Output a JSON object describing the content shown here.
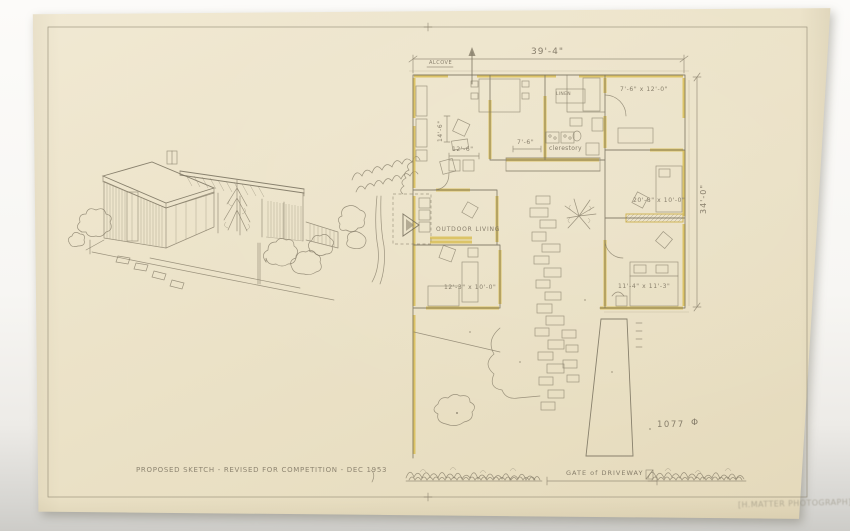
{
  "inscriptions": {
    "title": "PROPOSED SKETCH - REVISED FOR COMPETITION - DEC 1953",
    "gate": "GATE of DRIVEWAY",
    "lot_number": "1077",
    "lot_symbol": "Φ",
    "stamp": "[H.MATTER PHOTOGRAPH]"
  },
  "plan": {
    "dims": {
      "overall_width": "39'-4\"",
      "overall_depth": "34'-0\"",
      "living": "14'-6\"",
      "kitchen": "12'-6\"",
      "hall": "7'-6\""
    },
    "rooms": {
      "bedroom_ne": "7'-6\" x 12'-0\"",
      "bedroom_e": "20'-8\" x 10'-0\"",
      "bedroom_se": "11'-4\" x 11'-3\"",
      "study_sw": "12'-3\" x 10'-0\""
    },
    "labels": {
      "linen": "LINEN",
      "clerestory": "clerestory",
      "outdoor_living": "OUTDOOR LIVING",
      "alcove": "ALCOVE"
    }
  },
  "colors": {
    "paper": "#ebe2c7",
    "pencil": "#857c68",
    "wall_highlight": "#d8bc4d",
    "mat": "#cfceca"
  }
}
